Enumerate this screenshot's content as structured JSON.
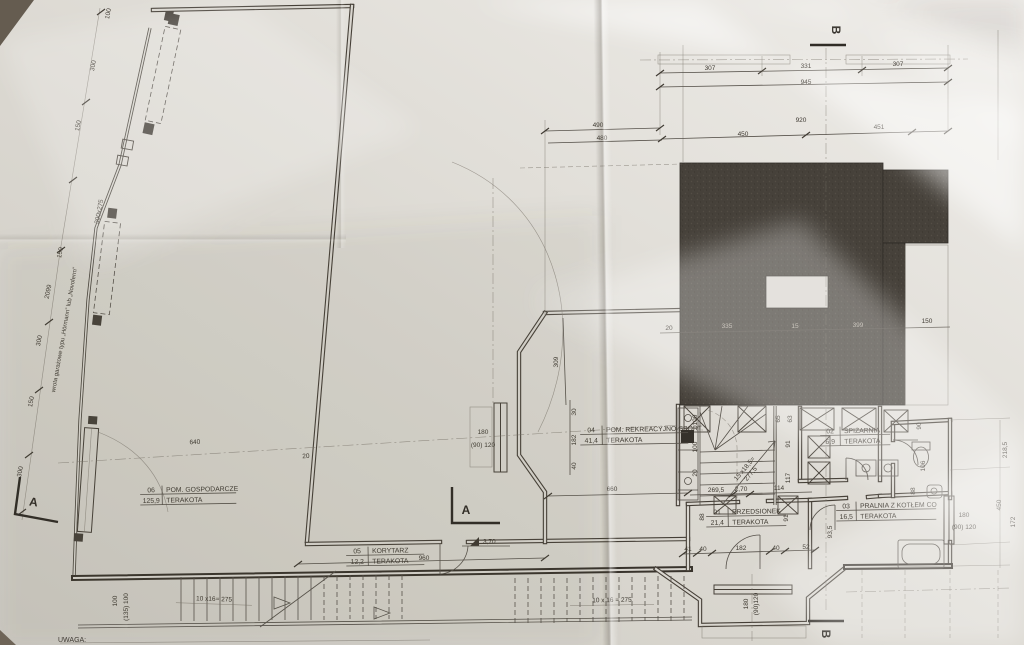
{
  "meta": {
    "sheet_note": "UWAGA:"
  },
  "rooms": [
    {
      "no": "01",
      "name": "PRZEDSIONEK",
      "area": "21,4",
      "finish": "TERAKOTA"
    },
    {
      "no": "02",
      "name": "SPIŻARNIA",
      "area": "6,9",
      "finish": "TERAKOTA"
    },
    {
      "no": "03",
      "name": "PRALNIA Z KOTŁEM CO",
      "area": "16,5",
      "finish": "TERAKOTA"
    },
    {
      "no": "04",
      "name": "POM. REKREACYJNO-SPORT.",
      "area": "41,4",
      "finish": "TERAKOTA"
    },
    {
      "no": "05",
      "name": "KORYTARZ",
      "area": "12,2",
      "finish": "TERAKOTA"
    },
    {
      "no": "06",
      "name": "POM. GOSPODARCZE",
      "area": "125,9",
      "finish": "TERAKOTA"
    }
  ],
  "sections": {
    "a_left": "A",
    "a_mid": "A",
    "b_top": "B",
    "b_bottom": "B"
  },
  "gate": {
    "note": "wrota garażowe typu „Hörmann” lub „Novoferm”",
    "size": "300x275"
  },
  "levels": {
    "corridor": "3,70"
  },
  "stairs": {
    "ext_left": "10 x16= 275",
    "ext_right": "10 x 16 = 275",
    "int_line1": "15 x18,5=",
    "int_line2": "277,5",
    "landing_a": "100",
    "landing_b": "(135) 100"
  },
  "windows": {
    "left": {
      "h": "180",
      "s": "(90) 120"
    },
    "bay": {
      "h": "180",
      "s": "(90)120"
    },
    "right": {
      "h": "180",
      "s": "(90) 120"
    }
  },
  "dims": {
    "top": [
      "307",
      "331",
      "945",
      "307",
      "490",
      "480",
      "450",
      "920",
      "451"
    ],
    "upper": [
      "20",
      "335",
      "15",
      "399",
      "150"
    ],
    "left": [
      "100",
      "300",
      "150",
      "150",
      "2099",
      "300",
      "150",
      "300",
      "640",
      "20"
    ],
    "mid": [
      "309",
      "30",
      "182",
      "40",
      "660",
      "269,5",
      "2,70",
      "114",
      "960"
    ],
    "stairwell": [
      "100",
      "100",
      "20",
      "65",
      "63",
      "91",
      "117"
    ],
    "lower": [
      "41",
      "40",
      "182",
      "40",
      "52",
      "88",
      "91",
      "93,5"
    ],
    "right": [
      "218,5",
      "450",
      "172",
      "90",
      "106",
      "88"
    ]
  }
}
